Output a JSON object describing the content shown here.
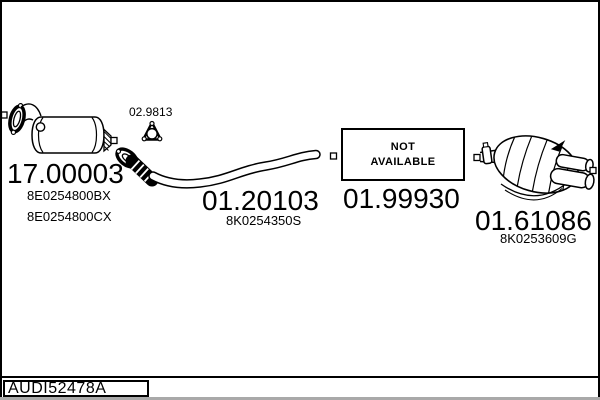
{
  "diagram_type": "exhaust-system-parts-diagram",
  "footer": {
    "code": "AUDI52478A"
  },
  "colors": {
    "line": "#000000",
    "background": "#ffffff",
    "frame": "#000000",
    "bottom_strip": "#a9a9a9"
  },
  "parts": [
    {
      "name": "catalytic-converter",
      "number": "17.00003",
      "oe_refs": [
        "8E0254800BX",
        "8E0254800CX"
      ]
    },
    {
      "name": "triangular-gasket",
      "number": "02.9813",
      "oe_refs": []
    },
    {
      "name": "flexible-front-pipe",
      "number": "01.20103",
      "oe_refs": [
        "8K0254350S"
      ]
    },
    {
      "name": "centre-section",
      "number": "01.99930",
      "availability": {
        "line1": "NOT",
        "line2": "AVAILABLE"
      }
    },
    {
      "name": "rear-silencer",
      "number": "01.61086",
      "oe_refs": [
        "8K0253609G"
      ]
    }
  ],
  "drawings": [
    "catalytic-converter-drawing",
    "triangular-gasket-icon",
    "flexible-front-pipe-drawing",
    "not-available-box",
    "rear-silencer-drawing",
    "mount-square-markers"
  ]
}
